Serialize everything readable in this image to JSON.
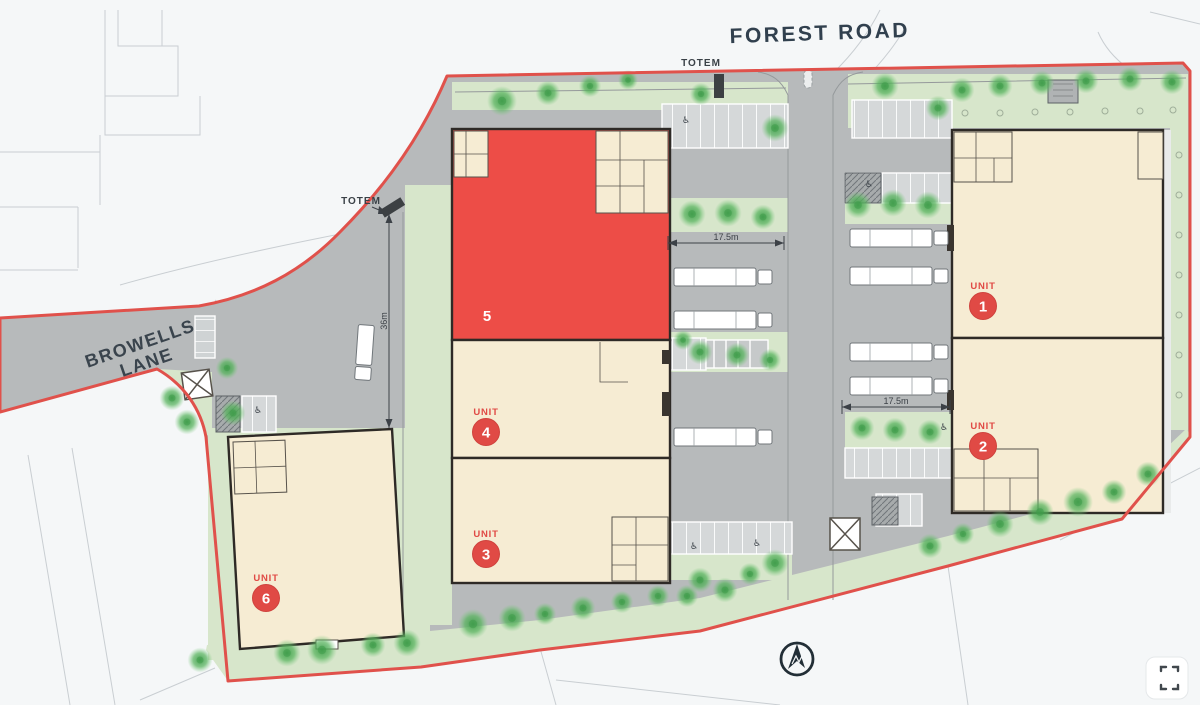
{
  "title": "Industrial estate site plan",
  "roads": {
    "forest_road": "FOREST ROAD",
    "browells_line1": "BROWELLS",
    "browells_line2": "LANE"
  },
  "annotations": {
    "totem": "TOTEM",
    "dim_left_court": "17.5m",
    "dim_right_court": "17.5m",
    "dim_yard": "36m"
  },
  "units": {
    "u1": {
      "word": "UNIT",
      "number": "1"
    },
    "u2": {
      "word": "UNIT",
      "number": "2"
    },
    "u3": {
      "word": "UNIT",
      "number": "3"
    },
    "u4": {
      "word": "UNIT",
      "number": "4"
    },
    "u5": {
      "number": "5",
      "highlighted": true
    },
    "u6": {
      "word": "UNIT",
      "number": "6"
    }
  },
  "colors": {
    "boundary_red": "#e0514b",
    "unit_highlight_red": "#ed4d47",
    "label_red": "#e04a45",
    "building_beige": "#f6ecd3",
    "landscape_green": "#d7e6cb",
    "hardstanding_grey": "#b7babb",
    "road_label_slate": "#31404e"
  }
}
